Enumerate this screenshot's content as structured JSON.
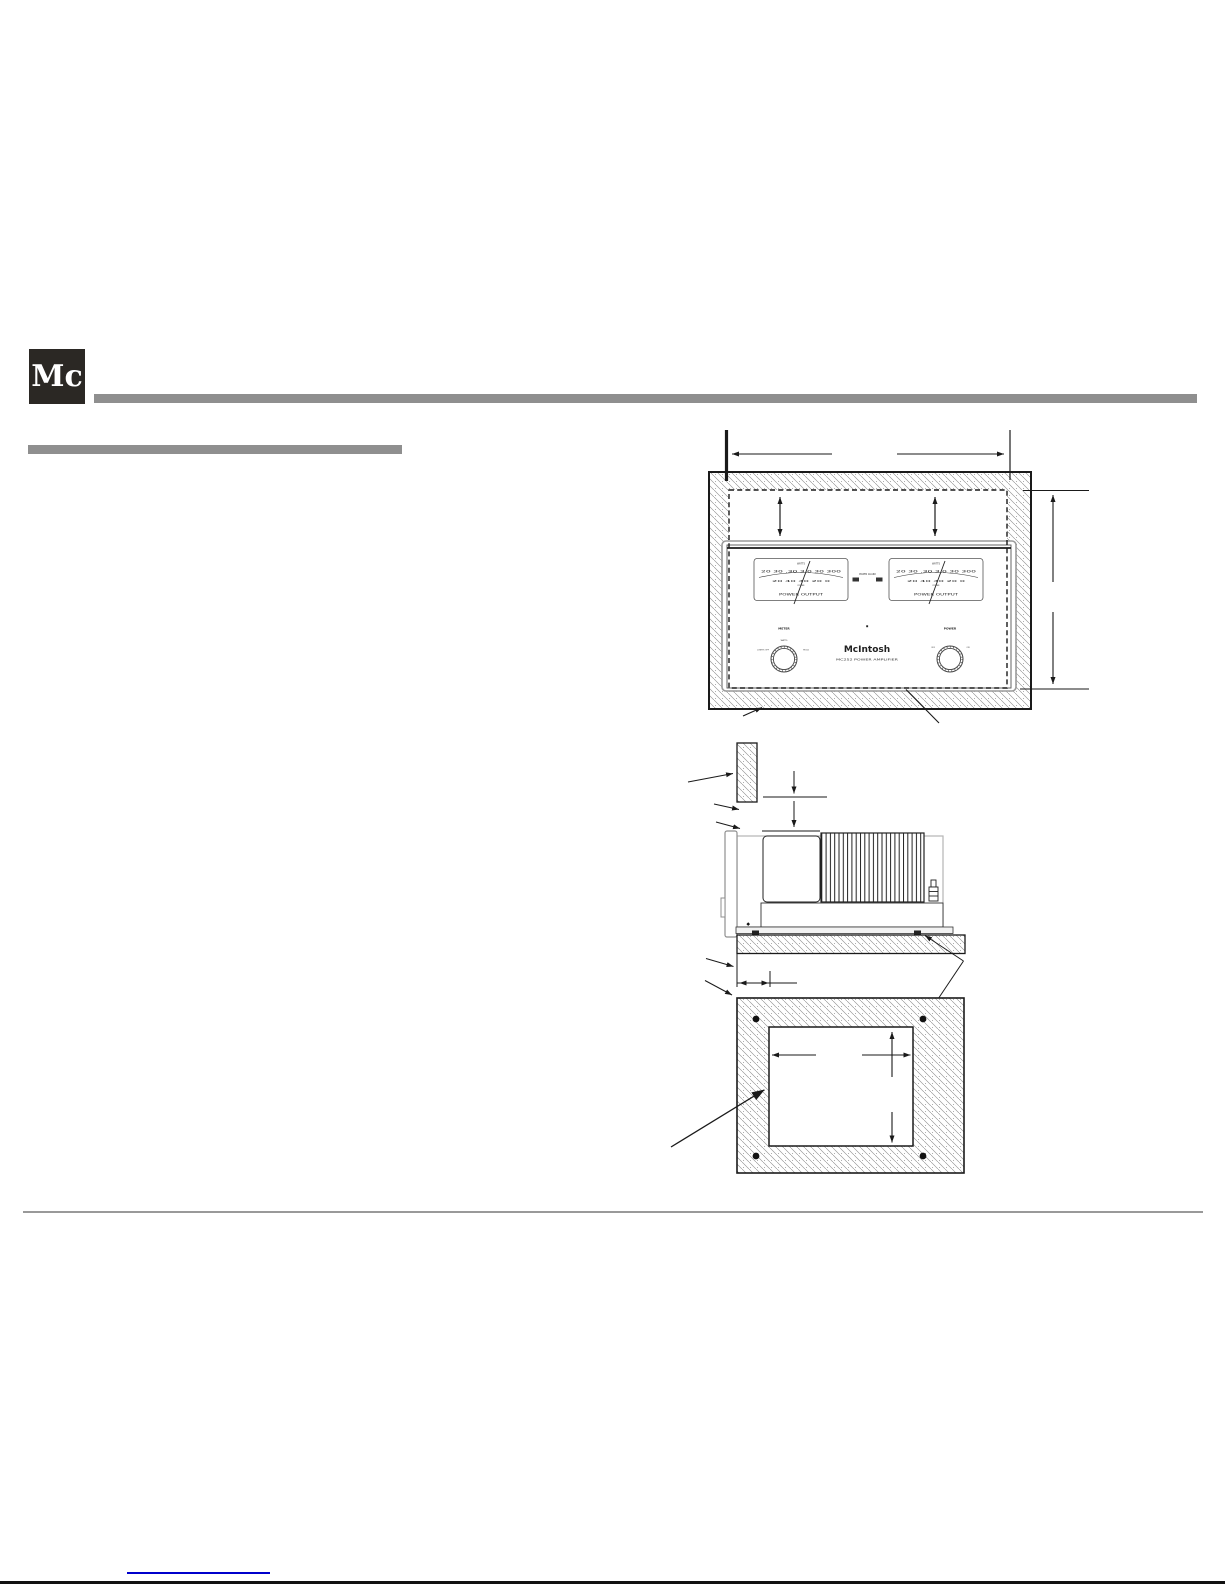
{
  "header": {
    "logo_text": "Mc"
  },
  "colors": {
    "bar_gray": "#8f8f8f",
    "logo_bg": "#2b2824",
    "link_blue": "#0000cc",
    "bottom_line_black": "#111111",
    "diagram_ink": "#1a1a1a"
  },
  "front_panel": {
    "brand": "McIntosh",
    "model_line": "MC252 POWER AMPLIFIER",
    "power_guard_label": "POWER GUARD",
    "meters": {
      "watts_label": "WATTS",
      "scale_row1": "20 30 .30 3.0 30 300",
      "scale_row2": "20 40 40 20 0",
      "scale_caption": "POWER",
      "bottom_label": "POWER OUTPUT"
    },
    "knobs": {
      "left_label": "METER",
      "left_pos_top": "WATTS",
      "left_pos_left": "LIGHTS OFF",
      "left_pos_right": "HOLD",
      "right_label": "POWER",
      "right_pos_left": "OFF",
      "right_pos_right": "ON"
    }
  },
  "diagrams": {
    "views": [
      "front-cutout-view",
      "side-view",
      "bottom-shelf-view"
    ]
  }
}
